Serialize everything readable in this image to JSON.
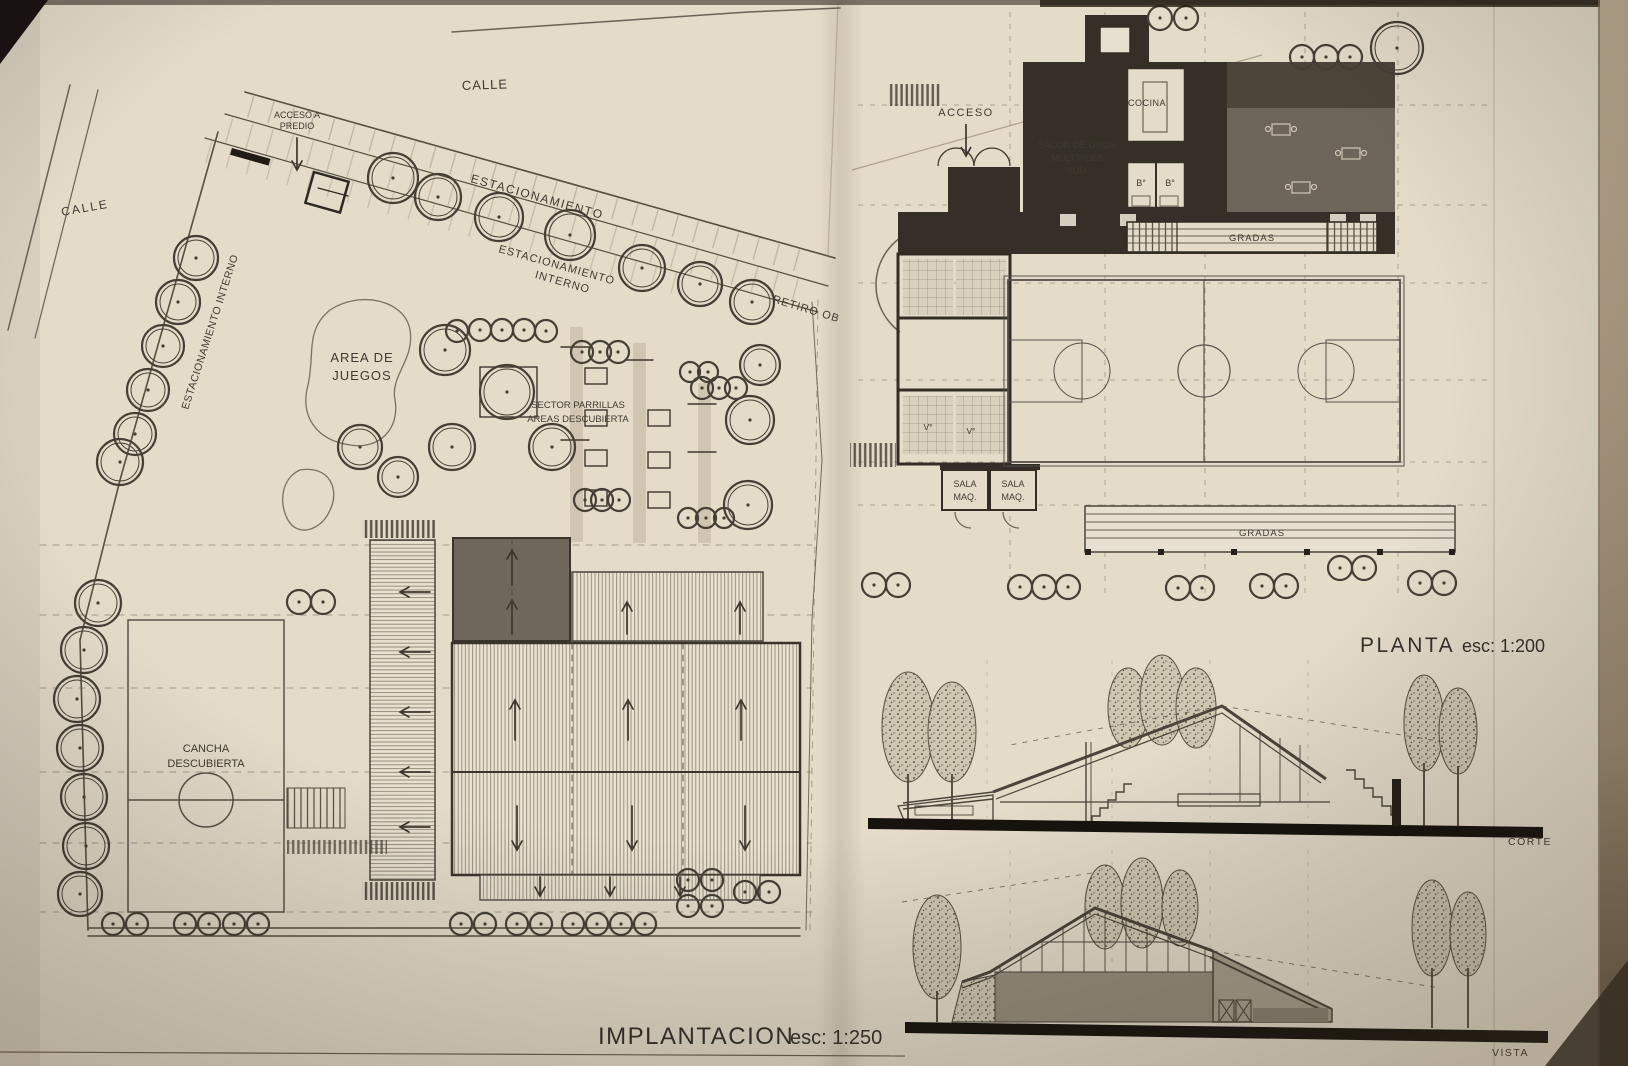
{
  "titles": {
    "implantacion": "IMPLANTACION",
    "implantacion_scale": "esc: 1:250",
    "planta": "PLANTA",
    "planta_scale": "esc: 1:200"
  },
  "site_plan": {
    "street_top": "CALLE",
    "street_left": "CALLE",
    "access_l1": "ACCESO A",
    "access_l2": "PREDIO",
    "parking": "ESTACIONAMIENTO",
    "parking_internal_l1": "ESTACIONAMIENTO",
    "parking_internal_l2": "INTERNO",
    "parking_internal_side": "ESTACIONAMIENTO INTERNO",
    "setback": "RETIRO OB",
    "playground_l1": "AREA DE",
    "playground_l2": "JUEGOS",
    "grill_l1": "SECTOR PARRILLAS",
    "grill_l2": "AREAS DESCUBIERTA",
    "court_l1": "CANCHA",
    "court_l2": "DESCUBIERTA"
  },
  "floor_plan": {
    "access": "ACCESO",
    "kitchen": "COCINA",
    "hall_l1": "SALON DE USOS",
    "hall_l2": "MULTIPLES",
    "hall_l3": "SUM",
    "bath_1": "B°",
    "bath_2": "B°",
    "locker_1": "V°",
    "locker_2": "V°",
    "stands_top": "GRADAS",
    "stands_bottom": "GRADAS",
    "machine_room_1_l1": "SALA",
    "machine_room_1_l2": "MAQ.",
    "machine_room_2_l1": "SALA",
    "machine_room_2_l2": "MAQ."
  },
  "section_label": "CORTE",
  "elevation_label": "VISTA",
  "colors": {
    "paper": "#e4dbc9",
    "ink": "#4a443a",
    "wall_dark": "#332d25",
    "roof_dark": "#6f675a"
  }
}
